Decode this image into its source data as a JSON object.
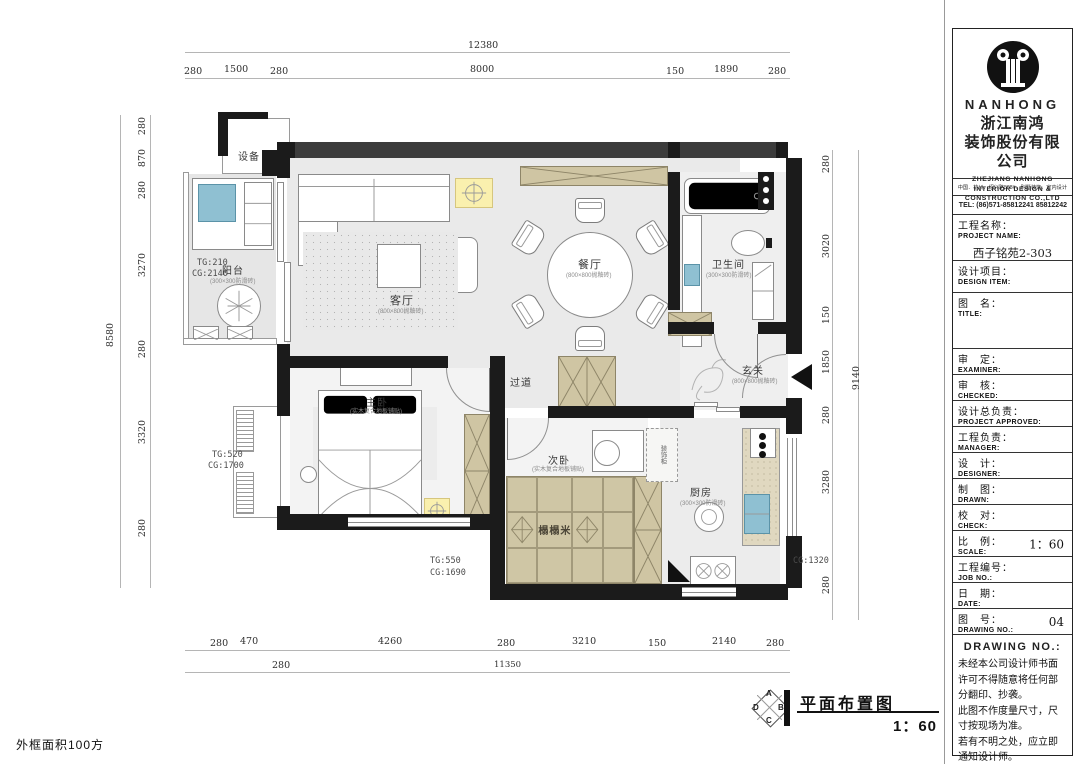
{
  "colors": {
    "wall_black": "#1b1b1b",
    "wall_gray": "#3c3c3c",
    "cabinet_tan": "#cfc5a3",
    "highlight_yellow": "#faf0ae",
    "appliance_blue": "#8fc0d2",
    "floor_gray": "#e9e9e9"
  },
  "plan": {
    "rooms": {
      "shebei": {
        "label": "设备"
      },
      "yangtai": {
        "label": "阳台",
        "sub": "(300×300防滑砖)"
      },
      "keting": {
        "label": "客厅",
        "sub": "(800×800抛釉砖)"
      },
      "canting": {
        "label": "餐厅",
        "sub": "(800×800抛釉砖)"
      },
      "weishengjian": {
        "label": "卫生间",
        "sub": "(300×300防滑砖)"
      },
      "xuanguan": {
        "label": "玄关",
        "sub": "(800×800抛釉砖)"
      },
      "guodao": {
        "label": "过道"
      },
      "zhuwo": {
        "label": "主卧",
        "sub": "(实木复合地板铺贴)"
      },
      "ciwo": {
        "label": "次卧",
        "sub": "(实木复合地板铺贴)"
      },
      "tatami": {
        "label": "榻榻米"
      },
      "chufang": {
        "label": "厨房",
        "sub": "(300×300防滑砖)"
      },
      "kitchen_cabinet": {
        "label": "装饰柜"
      }
    },
    "annotations": {
      "balcony_tg": "TG:210",
      "balcony_cg": "CG:2140",
      "bay_tg": "TG:520",
      "bay_cg": "CG:1700",
      "master_tg": "TG:550",
      "master_cg": "CG:1690",
      "kitchen_cg": "CG:1320"
    },
    "dims": {
      "top": {
        "total": "12380",
        "segments": [
          "280",
          "1500",
          "280",
          "8000",
          "150",
          "1890",
          "280"
        ]
      },
      "bottom": {
        "row1": [
          "280",
          "470",
          "4260",
          "280",
          "3210",
          "150",
          "2140",
          "280"
        ],
        "row2": [
          "280",
          "11350"
        ]
      },
      "left": {
        "total": "8580",
        "segments": [
          "280",
          "870",
          "280",
          "3270",
          "280",
          "3320",
          "280"
        ]
      },
      "right": {
        "total": "9140",
        "segments": [
          "280",
          "3020",
          "150",
          "1850",
          "280",
          "3280",
          "280"
        ]
      }
    }
  },
  "footer": {
    "area_note": "外框面积100方",
    "plan_title": "平面布置图",
    "scale": "1：60",
    "compass": {
      "a": "A",
      "b": "B",
      "c": "C",
      "d": "D"
    }
  },
  "title_block": {
    "brand": "NANHONG",
    "company_cn_1": "浙江南鸿",
    "company_cn_2": "装饰股份有限公司",
    "company_en_1": "ZHEJIANG NANHONG",
    "company_en_2": "INTERIOR DESIGN &",
    "company_en_3": "CONSTRUCTION CO.,LTD",
    "address": "中国．杭州．绍兴路508#．别墅装饰．室内设计",
    "tel": "TEL: (86)571-85812241  85812242",
    "fields": [
      {
        "cn": "工程名称：",
        "en": "PROJECT NAME:",
        "value": "西子铭苑2-303"
      },
      {
        "cn": "设计项目：",
        "en": "DESIGN ITEM:",
        "value": ""
      },
      {
        "cn": "图　名：",
        "en": "TITLE:",
        "value": ""
      },
      {
        "cn": "审　定：",
        "en": "EXAMINER:",
        "value": ""
      },
      {
        "cn": "审　核：",
        "en": "CHECKED:",
        "value": ""
      },
      {
        "cn": "设计总负责：",
        "en": "PROJECT APPROVED:",
        "value": ""
      },
      {
        "cn": "工程负责：",
        "en": "MANAGER:",
        "value": ""
      },
      {
        "cn": "设　计：",
        "en": "DESIGNER:",
        "value": ""
      },
      {
        "cn": "制　图：",
        "en": "DRAWN:",
        "value": ""
      },
      {
        "cn": "校　对：",
        "en": "CHECK:",
        "value": ""
      },
      {
        "cn": "比　例：",
        "en": "SCALE:",
        "value": "1：60"
      },
      {
        "cn": "工程编号：",
        "en": "JOB NO.:",
        "value": ""
      },
      {
        "cn": "日　期：",
        "en": "DATE:",
        "value": ""
      },
      {
        "cn": "图　号：",
        "en": "DRAWING NO.:",
        "value": "04"
      }
    ],
    "notice": {
      "title": "DRAWING NO.:",
      "lines": [
        "未经本公司设计师书面许可不得随意将任何部分翻印、抄袭。",
        "此图不作度量尺寸，尺寸按现场为准。",
        "若有不明之处，应立即通知设计师。"
      ]
    }
  }
}
